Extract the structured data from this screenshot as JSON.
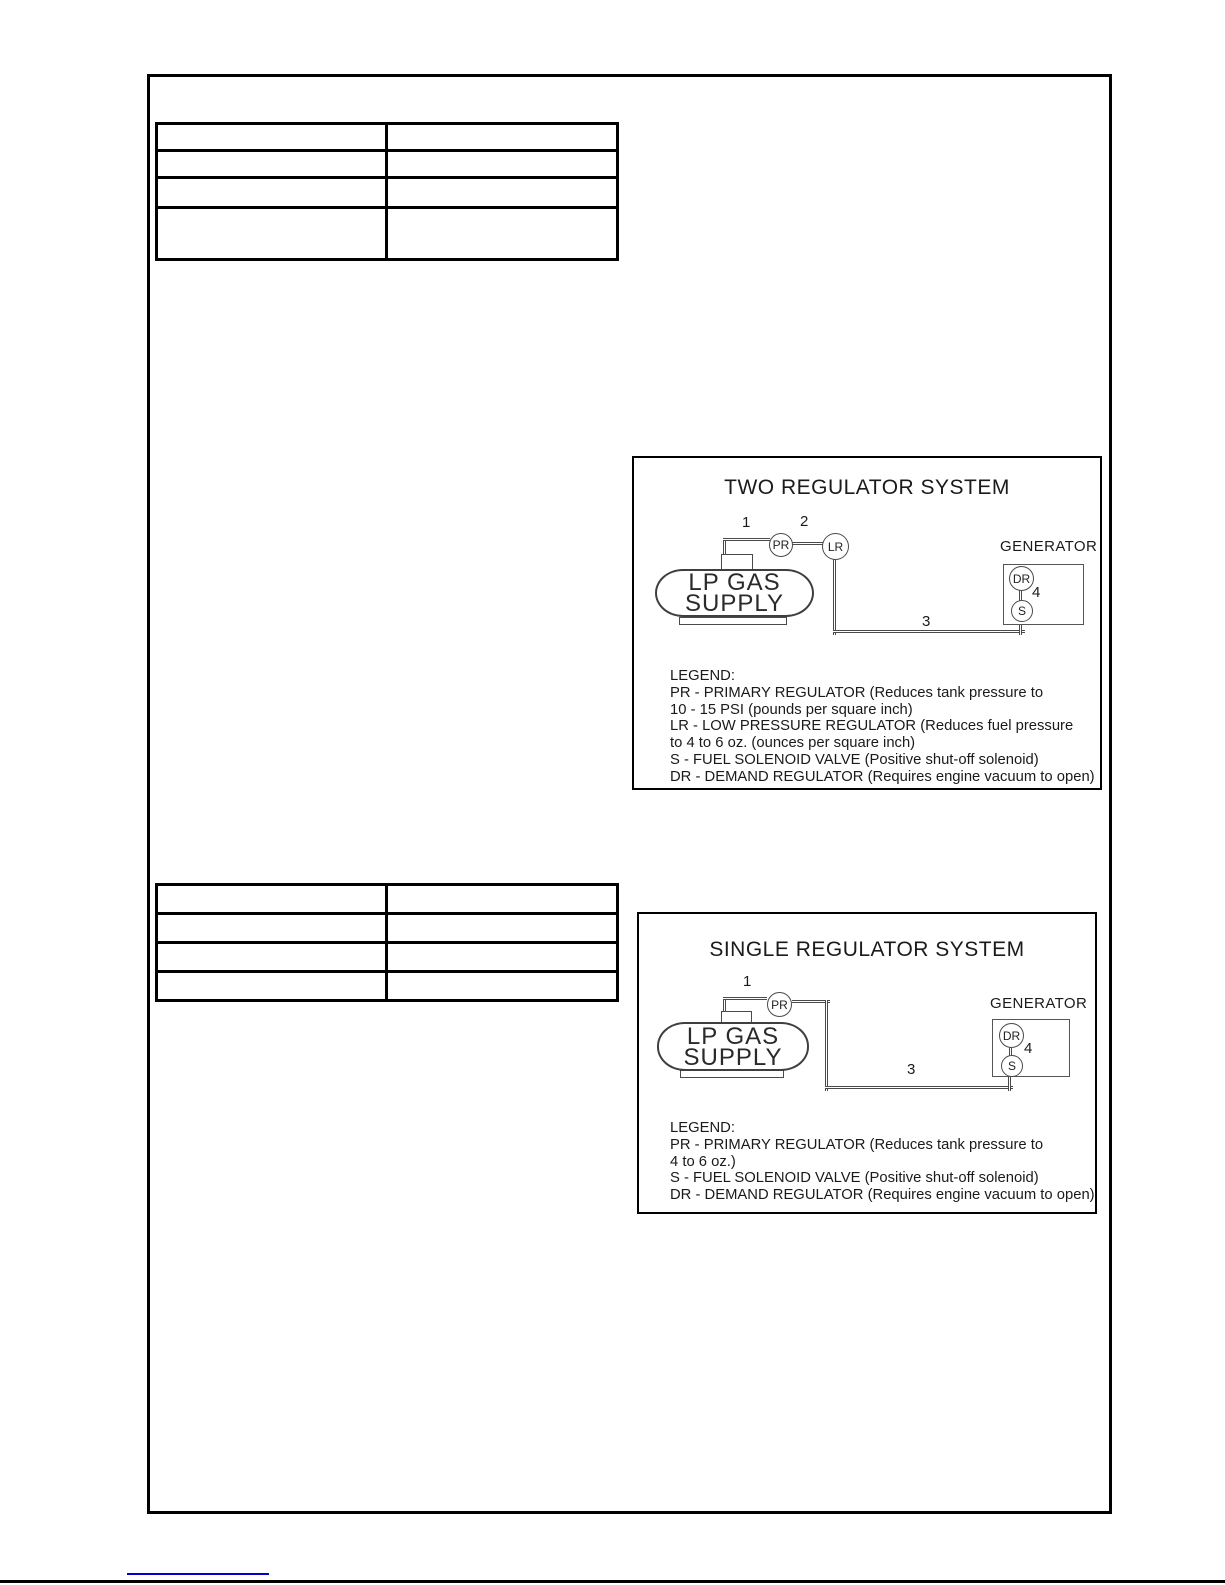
{
  "page": {
    "background_color": "#ffffff",
    "border_color": "#000000"
  },
  "top_table": {
    "rows": [
      [
        "",
        ""
      ],
      [
        "",
        ""
      ],
      [
        "",
        ""
      ],
      [
        "",
        ""
      ]
    ]
  },
  "middle_table": {
    "rows": [
      [
        "",
        ""
      ],
      [
        "",
        ""
      ],
      [
        "",
        ""
      ],
      [
        "",
        ""
      ]
    ]
  },
  "two_regulator_diagram": {
    "title": "TWO REGULATOR SYSTEM",
    "tank": {
      "line1": "LP GAS",
      "line2": "SUPPLY"
    },
    "generator_label": "GENERATOR",
    "nodes": {
      "pr": "PR",
      "lr": "LR",
      "dr": "DR",
      "s": "S"
    },
    "callouts": {
      "c1": "1",
      "c2": "2",
      "c3": "3",
      "c4": "4"
    },
    "legend": [
      "LEGEND:",
      "PR - PRIMARY REGULATOR (Reduces tank pressure to",
      "10 - 15 PSI (pounds per square inch)",
      "LR - LOW PRESSURE REGULATOR (Reduces fuel pressure",
      "to 4 to 6 oz. (ounces per square inch)",
      "S - FUEL SOLENOID VALVE (Positive shut-off solenoid)",
      "DR - DEMAND REGULATOR (Requires engine vacuum to open)"
    ]
  },
  "single_regulator_diagram": {
    "title": "SINGLE REGULATOR SYSTEM",
    "tank": {
      "line1": "LP GAS",
      "line2": "SUPPLY"
    },
    "generator_label": "GENERATOR",
    "nodes": {
      "pr": "PR",
      "dr": "DR",
      "s": "S"
    },
    "callouts": {
      "c1": "1",
      "c3": "3",
      "c4": "4"
    },
    "legend": [
      "LEGEND:",
      "PR - PRIMARY REGULATOR (Reduces tank pressure to",
      "4 to 6 oz.)",
      "S - FUEL SOLENOID VALVE (Positive shut-off solenoid)",
      "DR - DEMAND REGULATOR (Requires engine vacuum to open)"
    ]
  },
  "footer": {
    "link_underline_color": "#0000cc"
  }
}
